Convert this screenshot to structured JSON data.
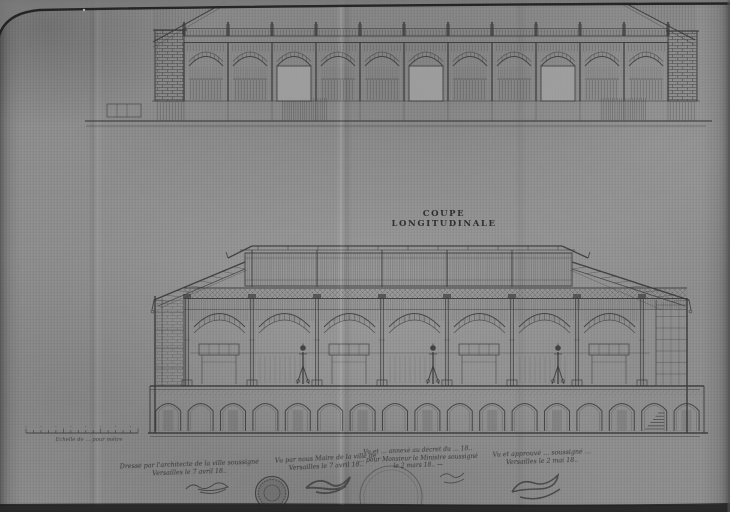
{
  "colors": {
    "paper": "#8e8e8e",
    "ink": "#343434",
    "edge_dark": "#1a1a1a"
  },
  "title": "COUPE LONGITUDINALE",
  "scale_bar": {
    "caption": "Echelle de … pour mètre"
  },
  "notes": {
    "architect": {
      "lines": [
        "Dressé par l'architecte de la ville soussigné",
        "Versailles le 7 avril 18.."
      ]
    },
    "mayor": {
      "lines": [
        "Vu par nous Maire de la ville de",
        "Versailles le 7 avril 18.."
      ]
    },
    "prefect": {
      "lines": [
        "Vu et … annexé au décret du … 18..",
        "… pour Monsieur le Ministre soussigné",
        "le 2 mars 18.. —"
      ]
    },
    "approval": {
      "lines": [
        "Vu et approuvé … soussigné …",
        "Versailles le 2 mai 18.."
      ]
    }
  },
  "stamps": [
    "ink-stamp",
    "embossed-stamp"
  ]
}
